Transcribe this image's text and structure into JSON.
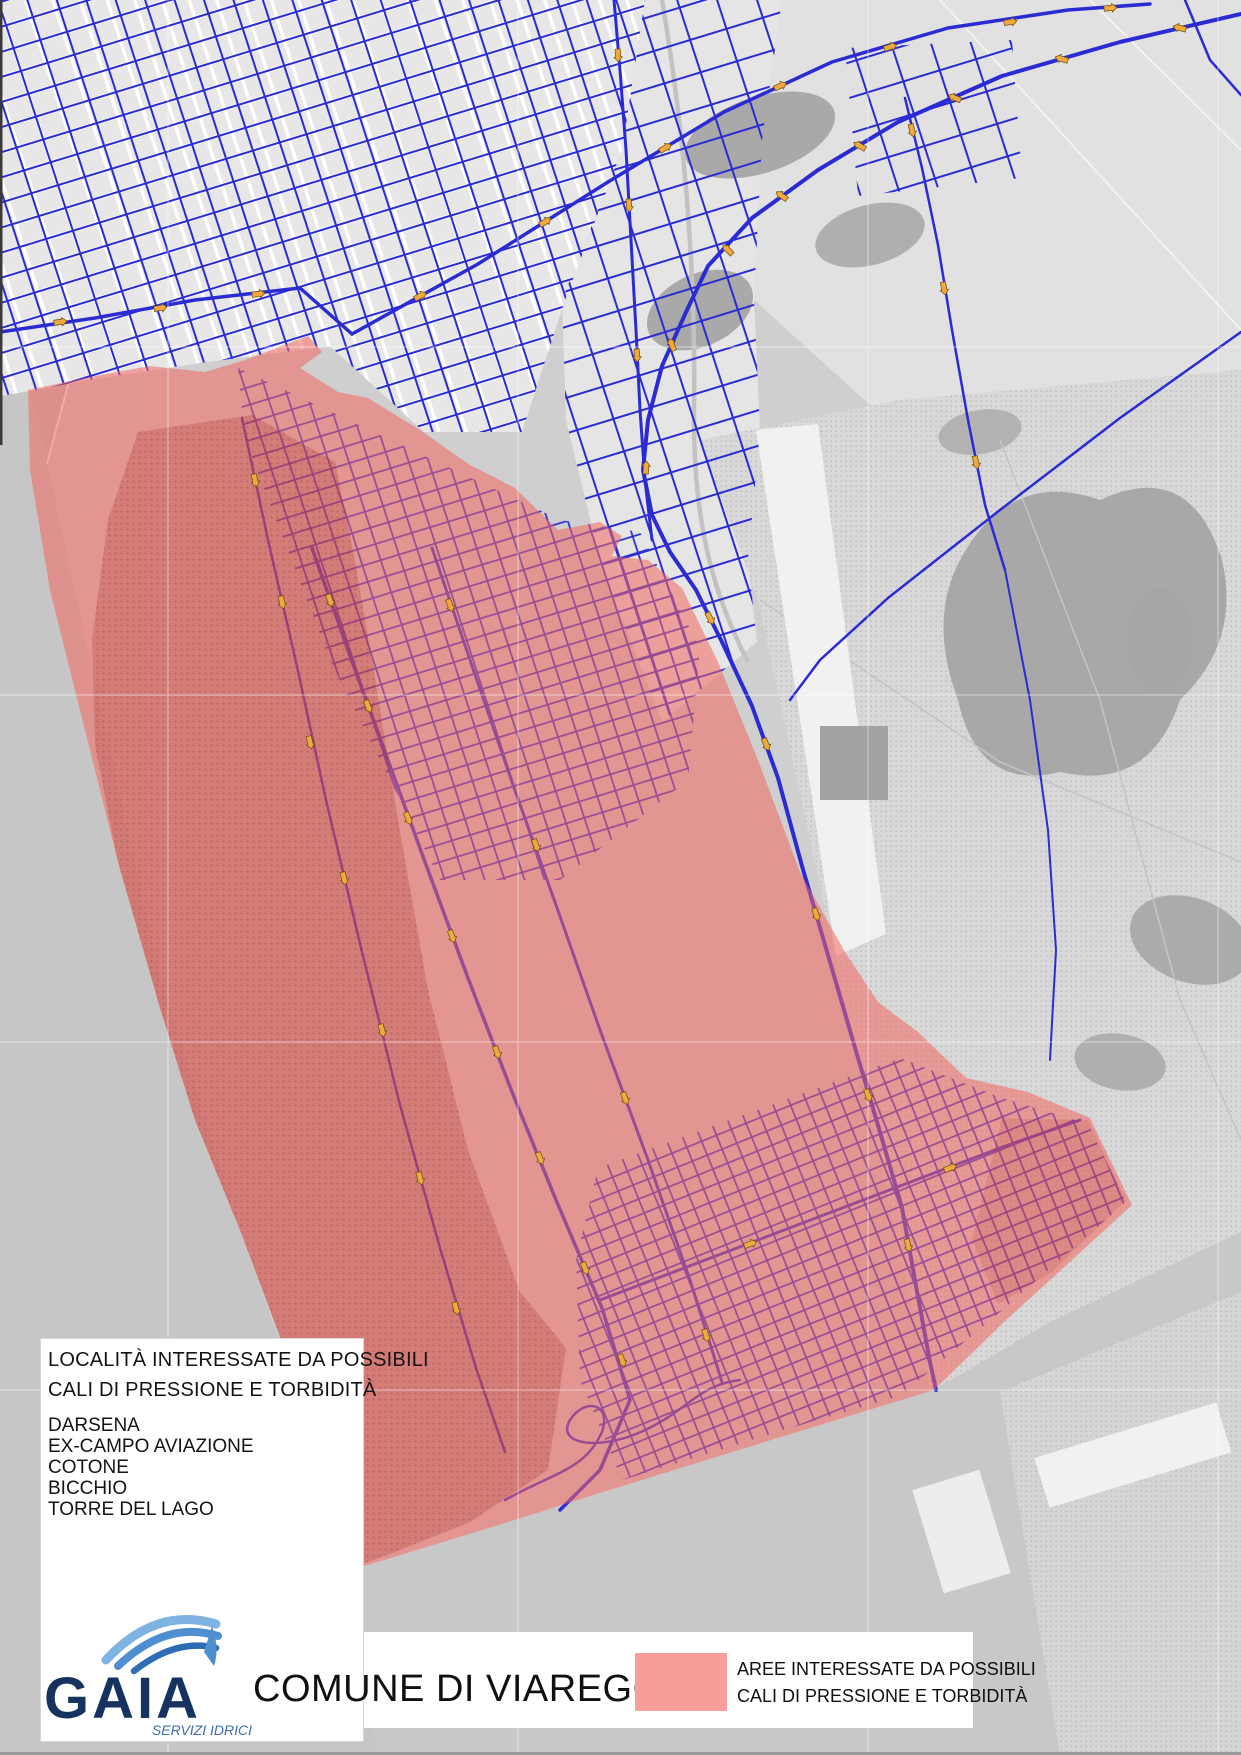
{
  "locality_box": {
    "title_line1": "LOCALITÀ INTERESSATE DA POSSIBILI",
    "title_line2": "CALI DI PRESSIONE E TORBIDITÀ",
    "localities": [
      "DARSENA",
      "EX-CAMPO AVIAZIONE",
      "COTONE",
      "BICCHIO",
      "TORRE DEL LAGO"
    ]
  },
  "footer": {
    "municipality_title": "COMUNE DI VIAREGGIO",
    "legend": {
      "swatch_color": "#F89E9A",
      "label_line1": "AREE INTERESSATE DA POSSIBILI",
      "label_line2": "CALI DI PRESSIONE E TORBIDITÀ"
    },
    "logo": {
      "name": "GAIA",
      "tagline": "SERVIZI IDRICI"
    }
  },
  "map": {
    "colors": {
      "highlight_overlay_red": "#F4685F",
      "highlight_dark_red": "#D07F7F",
      "water_network_blue": "#2B2BD4",
      "network_in_zone_purple": "#9A4D94",
      "flow_marker_orange": "#F0A93F",
      "urban_background": "#E8E8E8",
      "natural_area_gray": "#D8D8D8",
      "logo_navy": "#16335F",
      "logo_light_blue": "#5B9BD5"
    }
  }
}
